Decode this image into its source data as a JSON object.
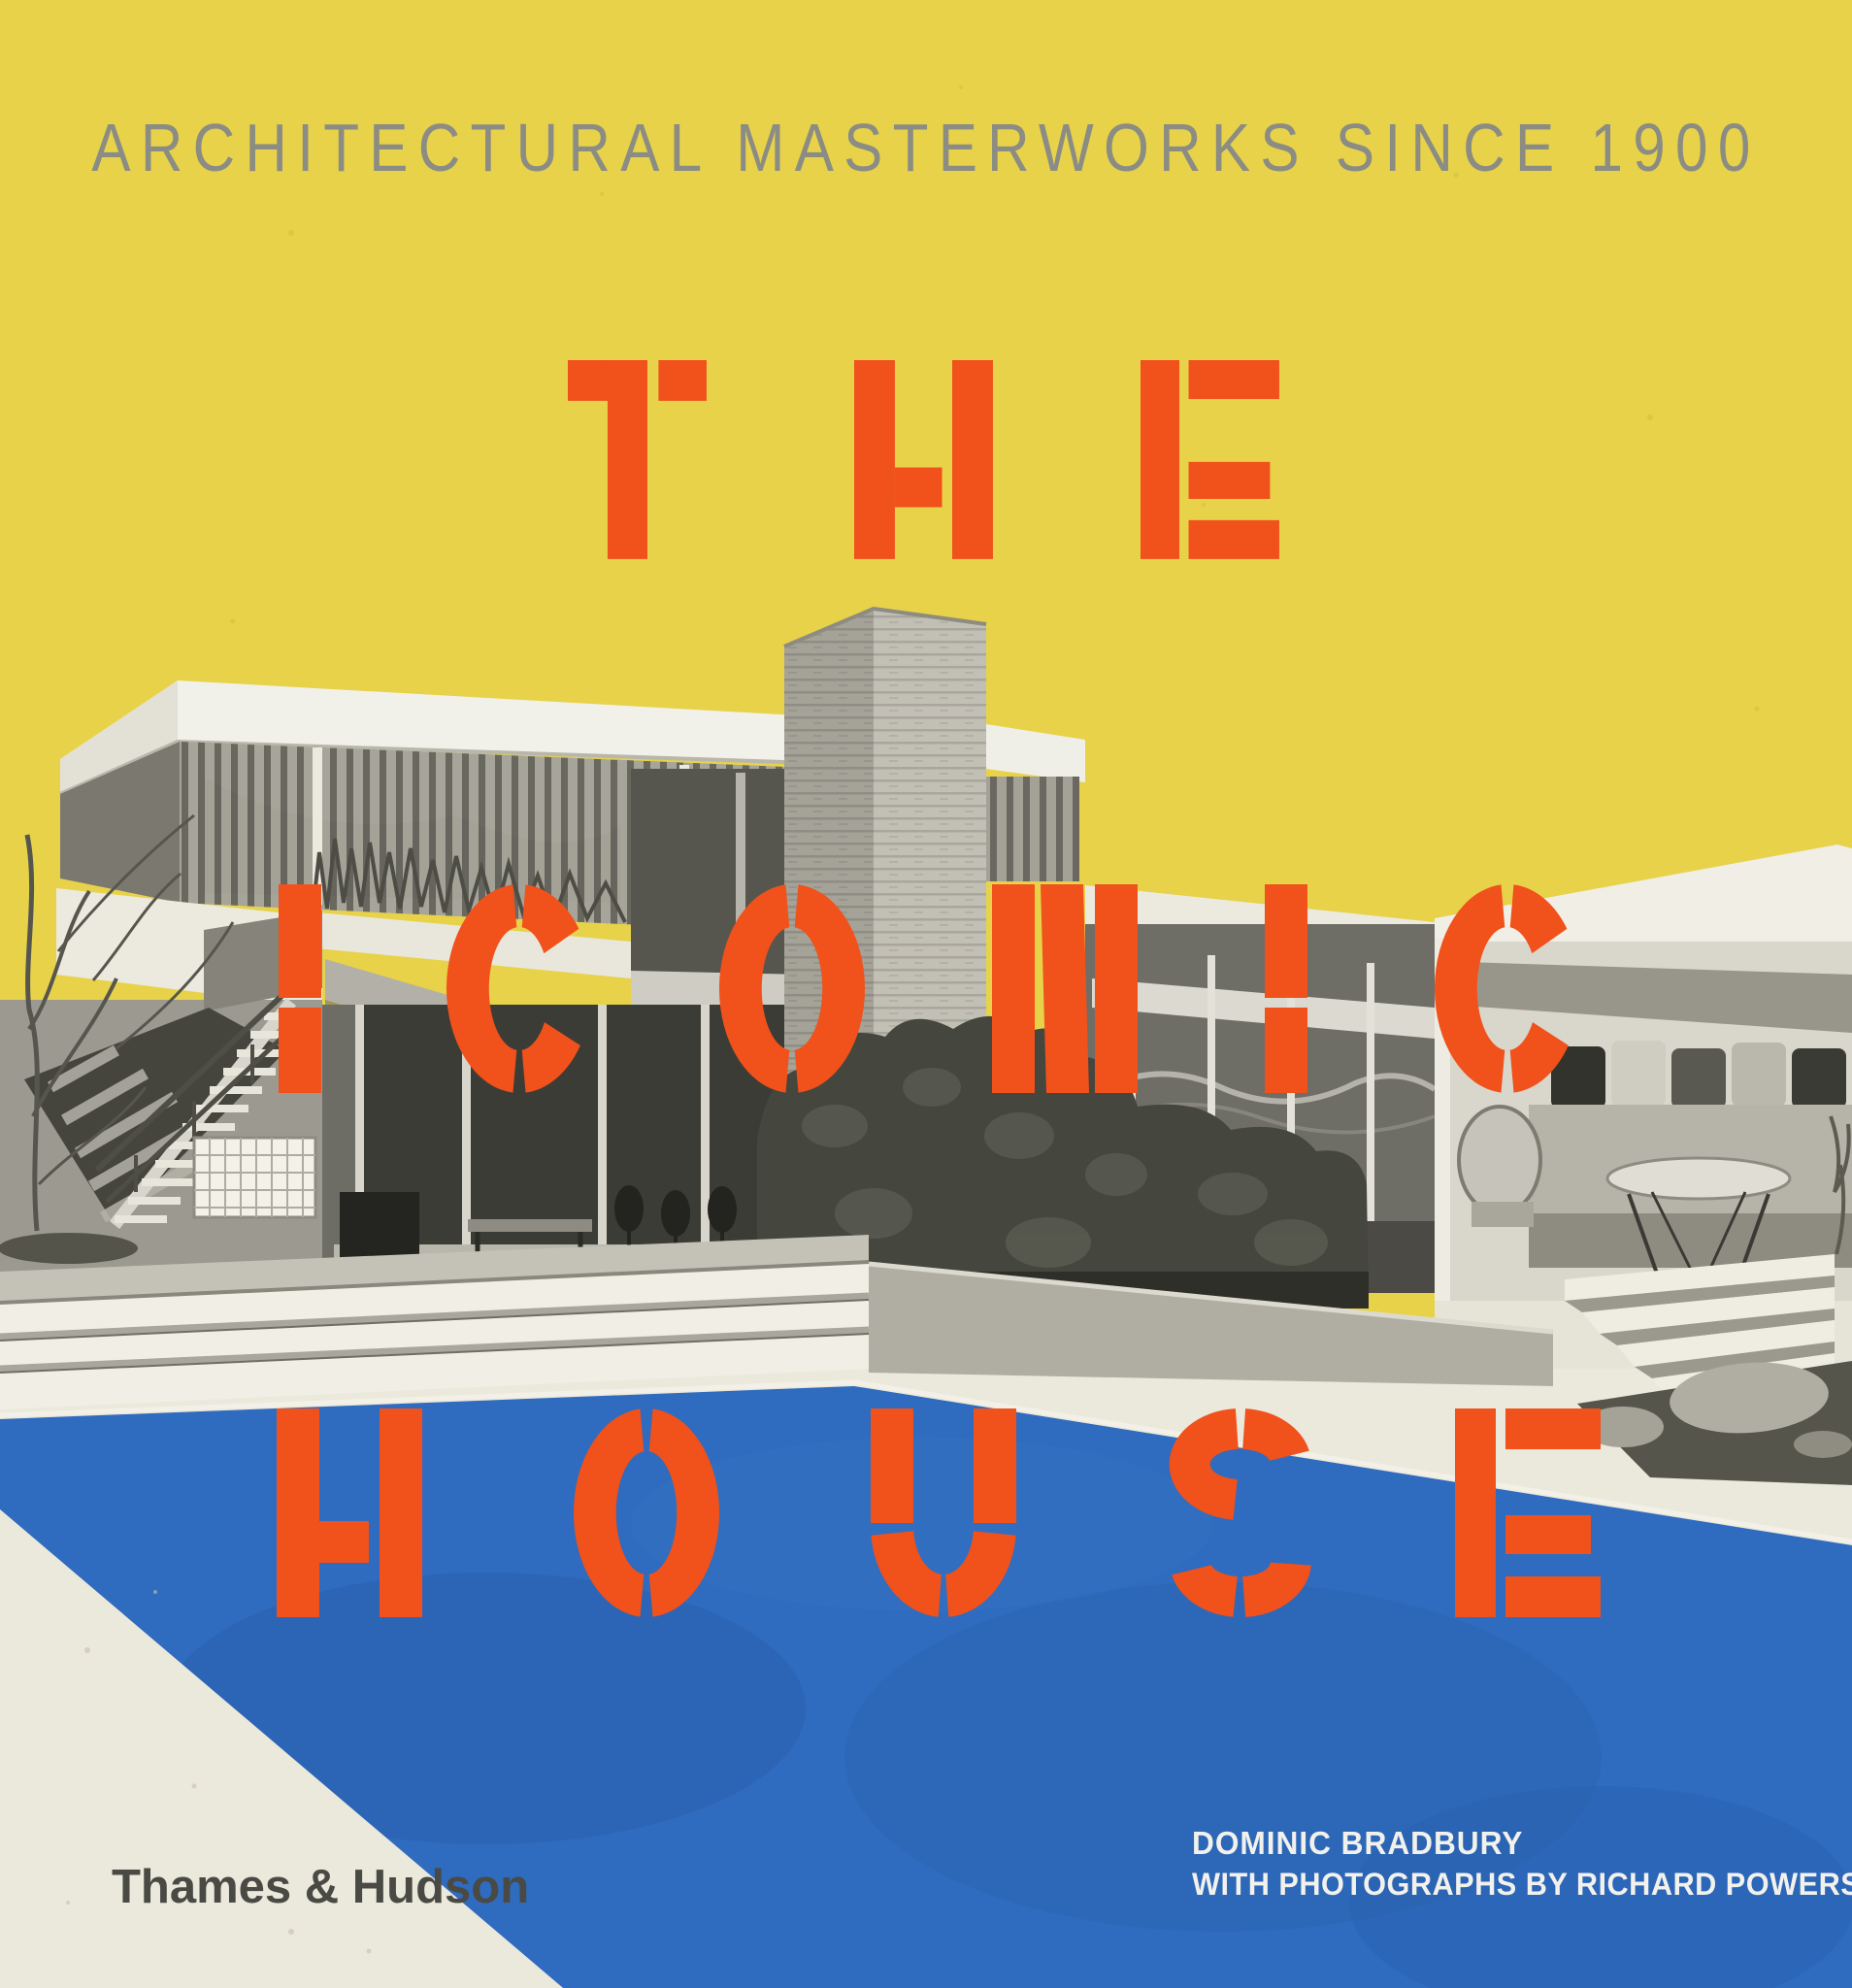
{
  "cover": {
    "subtitle": "ARCHITECTURAL MASTERWORKS SINCE 1900",
    "title_lines": [
      "THE",
      "ICONIC",
      "HOUSE"
    ],
    "publisher": "Thames & Hudson",
    "credits": [
      "DOMINIC BRADBURY",
      "WITH PHOTOGRAPHS BY RICHARD POWERS"
    ],
    "colors": {
      "yellow": "#e7d24a",
      "orange": "#f1511b",
      "pool": "#2f6bbe",
      "cream": "#ebe8dc",
      "subtitle_gray": "#8b8c83",
      "logo_gray": "#4a4a44",
      "credits_white": "#f2f1ec"
    }
  }
}
